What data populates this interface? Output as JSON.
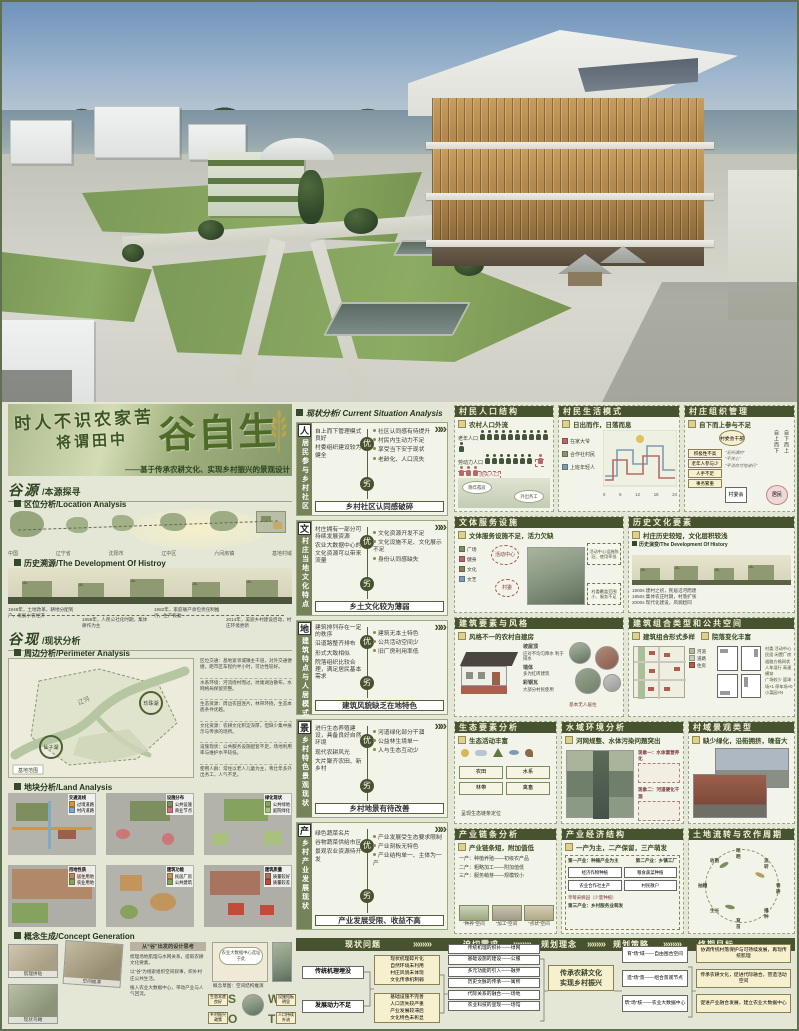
{
  "title": {
    "line1": "时人不识农家苦",
    "line2": "将谓田中",
    "big": "谷自生",
    "subtitle": "——基于传承农耕文化、实现乡村振兴的景观设计"
  },
  "left": {
    "sec1_title": "谷源",
    "sec1_sub": "/本源探寻",
    "loc_label": "区位分析/Location Analysis",
    "loc_chain": [
      "中国",
      "辽宁省",
      "沈阳市",
      "辽中区",
      "六间房镇",
      "基地村域"
    ],
    "hist_label": "历史溯源/The Development Of Histroy",
    "hist_timeline": [
      "1948年，土地改革，耕地分配到户，发展小农经济",
      "1958年，人民公社化时期，集体耕作为主",
      "1982年，家庭联产承包责任制推行，生产恢复",
      "2014年，美丽乡村建设启动，村庄环境更新"
    ],
    "sec2_title": "谷现",
    "sec2_sub": "/现状分析",
    "peri_label": "周边分析/Perimeter Analysis",
    "peri_map": {
      "river": "辽河",
      "lake_right": "珍珠湖",
      "lake_left": "仙子湖",
      "corner": "基地范围"
    },
    "peri_notes": [
      "区位交通：基地紧邻城镇主干道，对外交通便捷，距市区车程约半小时，可达性较好。",
      "水系环境：河流绕村而过，坑塘湖泊散布，水网格局保留完整。",
      "生态资源：周边农田连片，林带环绕，生态本底条件优越。",
      "文化资源：农耕文化积淀深厚，但缺少集中展示与传承的场所。",
      "设施现状：公共服务设施配套不足，场地利用率与维护水平较低。",
      "使用人群：常住以老人儿童为主，青壮年多外出务工，人气不足。"
    ],
    "land_label": "地块分析/Land Analysis",
    "land_tiles": [
      {
        "name": "交通流线",
        "l1": "过境道路",
        "l2": "村内道路"
      },
      {
        "name": "设施分布",
        "l1": "公共设施",
        "l2": "商业节点"
      },
      {
        "name": "绿化现状",
        "l1": "公共绿地",
        "l2": "庭院绿化"
      },
      {
        "name": "用地性质",
        "l1": "居住用地",
        "l2": "农业用地"
      },
      {
        "name": "建筑功能",
        "l1": "民居厂房",
        "l2": "公共建筑"
      },
      {
        "name": "建筑质量",
        "l1": "质量较好",
        "l2": "质量较差"
      }
    ],
    "concept_label": "概念生成/Concept Generation",
    "concept": {
      "thumb1": "肌理拼贴",
      "thumb2": "空间推演",
      "thumb3": "现状鸟瞰",
      "head": "从“谷”出发的设计思考",
      "paras": [
        "梳理场地肌理与水网关系，提取农耕文化要素。",
        "以“谷”为线索组织空间叙事，织补村庄公共生活。",
        "植入农业大数据中心，带动产业与人气回流。"
      ],
      "sketch_note": "农业大数据中心选址于此",
      "sketch_caption": "概念草图：空间结构推演",
      "swot_letters": [
        "S",
        "W",
        "O",
        "T"
      ],
      "swot_notes": [
        "生态本底良好",
        "设施短板明显",
        "乡村振兴政策",
        "人口持续外流"
      ]
    }
  },
  "mid": {
    "header": "现状分析/ Current Situation Analysis",
    "panels": [
      {
        "tag": "人",
        "vertical": "居民参与乡村社区",
        "node_top": "优",
        "node_bottom": "劣",
        "left_items": [
          "自上而下管理模式良好",
          "村委组织建设较为健全"
        ],
        "right_items": [
          "社区认同感有待提升",
          "村民内生动力不足",
          "享受当下安于现状",
          "老龄化、人口流失"
        ],
        "banner": "乡村社区认同感破碎"
      },
      {
        "tag": "文",
        "vertical": "村庄当地文化特点",
        "node_top": "优",
        "node_bottom": "劣",
        "left_items": [
          "村庄拥有一部分可持续发展资源",
          "农业大数据中心的文化资源可以带来流量"
        ],
        "right_items": [
          "文化资源开发不足",
          "文化设施不足、文化展示不足",
          "身份认同感缺失"
        ],
        "banner": "乡土文化较为薄弱"
      },
      {
        "tag": "地",
        "vertical": "建筑特点与人居模式",
        "node_top": "优",
        "node_bottom": "劣",
        "left_items": [
          "建筑排列存在一定的秩序",
          "沿道路整齐排布",
          "形式大致相似",
          "院落组织比较合理，满足居民基本需求"
        ],
        "right_items": [
          "建筑无本土特色",
          "公共活动空间少",
          "旧厂房利用率低"
        ],
        "banner": "建筑风貌缺乏在地特色"
      },
      {
        "tag": "景",
        "vertical": "乡村特色景观现状",
        "node_top": "优",
        "node_bottom": "劣",
        "left_items": [
          "进行生态养殖建设，具备良好自然环境",
          "现代农耕风光",
          "大片聚齐农田、新乡村"
        ],
        "right_items": [
          "河道绿化部分干涸",
          "公益林生境单一",
          "人与生态互动少"
        ],
        "banner": "乡村地景有待改善"
      },
      {
        "tag": "产",
        "vertical": "乡村产业发展现状",
        "node_top": "优",
        "node_bottom": "劣",
        "left_items": [
          "绿色蔬菜名片",
          "谷物蔬菜供给市区",
          "景观农业资源待开发"
        ],
        "right_items": [
          "产业发展受生态要求限制",
          "产业刻板无特色",
          "产业结构单一、主体为一产"
        ],
        "banner": "产业发展受限、收益不高"
      }
    ]
  },
  "right": {
    "population": {
      "title": "村民人口结构",
      "sub": "农村人口外流",
      "rows": [
        {
          "label": "老年人口",
          "count": 11
        },
        {
          "label": "劳动力人口",
          "count": 7
        },
        {
          "label": "学龄儿童",
          "count": 3
        }
      ],
      "loss_label": "流失人口",
      "loss_count": 4,
      "bubbles": [
        "晚年孤寂",
        "外出务工"
      ]
    },
    "life": {
      "title": "村民生活模式",
      "sub": "日出而作，日落而息",
      "groups": [
        "在家大爷",
        "合作社村民",
        "上班年轻人"
      ],
      "axis": [
        "0",
        "6",
        "12",
        "18",
        "24"
      ]
    },
    "org": {
      "title": "村庄组织管理",
      "sub": "自下而上参与不足",
      "cadre": "村委会干部",
      "issues": [
        "积极性不高",
        "老年人参与少",
        "人手不足",
        "事务繁重"
      ],
      "down": "自上而下",
      "up": "自下而上",
      "committee": "村委会",
      "residents": "居民",
      "quotes": [
        "“无所谓的”",
        "“不关心”",
        "“平淡应付地进行”"
      ]
    },
    "facility": {
      "title": "文体服务设施",
      "sub": "文体服务设施不足，活力欠缺",
      "list": [
        "广场",
        "健身",
        "文化",
        "文艺"
      ],
      "nodes": [
        "活动中心",
        "村委"
      ],
      "notes": [
        "活动中心设施陈旧、使用率低",
        "村委覆盖范围小、服务不足"
      ]
    },
    "history": {
      "title": "历史文化要素",
      "sub": "村庄历史较短，文化层积较浅",
      "inner_label": "历史演变/The Development Of History",
      "notes": [
        "1900s 建村之初，民居沿河而建",
        "1950s 集体农庄时期，村落扩张",
        "2000s 现代化建设，风貌趋同"
      ]
    },
    "arch_elem": {
      "title": "建筑要素与风格",
      "sub": "风格不一的农村自建房",
      "callouts": [
        {
          "k": "坡屋顶",
          "v": "应对不均匀降水 利于排水"
        },
        {
          "k": "墙体",
          "v": "多为红砖建筑"
        },
        {
          "k": "彩钢瓦",
          "v": "大部分村民使用"
        }
      ],
      "note": "基本无人居住"
    },
    "arch_type": {
      "title": "建筑组合类型和公共空间",
      "sub1": "建筑组合形式多样",
      "sub2": "院落变化丰富",
      "legend": [
        "河道",
        "道路",
        "住房"
      ],
      "notes": [
        "村委 活动中心 民居 闲置厂房",
        "道路方格网状 人车混行 高速横穿",
        "广场较少 篮球场×1 停车场×0 小菜园×N"
      ]
    },
    "eco": {
      "title": "生态要素分析",
      "sub": "生态活动丰富",
      "elements": [
        "农田",
        "水系",
        "林带",
        "禽畜"
      ],
      "note": "呈现生态链条定位"
    },
    "water": {
      "title": "水域环境分析",
      "sub": "河网规整、水体污染问题突出",
      "cases": [
        "现象一：水体富营养化",
        "现象二：河道硬化干涸"
      ]
    },
    "street": {
      "title": "村域景观类型",
      "sub": "缺少绿化，沿街拥挤，噪音大"
    },
    "chain": {
      "title": "产业链条分析",
      "sub": "产业链条短，附加值低",
      "rows": [
        "一产：种植养殖——初级农产品",
        "二产：粗略加工——附加值低",
        "三产：服务萌芽——规模较小"
      ],
      "spaces": [
        "“种养”空间",
        "“加工”空间",
        "“点状”空间"
      ]
    },
    "economy": {
      "title": "产业经济结构",
      "sub": "一产为主，二产保留，三产萌发",
      "first": "第一产业：种植产业为主",
      "second": "第二产业：乡镇工厂",
      "boxes": [
        "经济作物种植",
        "粮食蔬菜种植",
        "农业合作社主产",
        "村民散户"
      ],
      "extra": "草莓采摘园（少量种植）",
      "third": "第三产业：乡村服务业萌发"
    },
    "cycle": {
      "title": "土地流转与农作周期",
      "stages": [
        "春耕",
        "播种",
        "育苗",
        "生长",
        "抽穗",
        "收割",
        "晾晒",
        "流转"
      ]
    }
  },
  "bottom": {
    "stages": [
      "现状问题",
      "迫切需求",
      "规划理念",
      "规划策略",
      "终期目标"
    ],
    "problems": [
      "传统机理埋没",
      "发展动力不足"
    ],
    "group1": [
      "现状机理碎片化",
      "自然环境未利用",
      "村庄风貌未体现",
      "文化传承机制弱"
    ],
    "group2": [
      "基础设施不完善",
      "人口流失较严重",
      "产业发展较滞后",
      "文化特色未彰显"
    ],
    "needs": [
      "传统机理的织补——绿网",
      "基础设施的建设——公服",
      "多元功能的引入——融界",
      "历史文脉的传承——寓所",
      "代际关系的融合——场地",
      "农业科技的呈现——场馆"
    ],
    "concept1": "传承农耕文化",
    "concept2": "实现乡村振兴",
    "strategies": [
      "育“场”域——自由围合空间",
      "造“场”景——组合景观节点",
      "筑“场”核——农业大数据中心"
    ],
    "goals": [
      "协调传统村落保护与可持续发展，再现传统肌理",
      "传承农耕文化，促进代际融合，营造活动空间",
      "促进产业融合发展，建立农业大数据中心"
    ]
  }
}
